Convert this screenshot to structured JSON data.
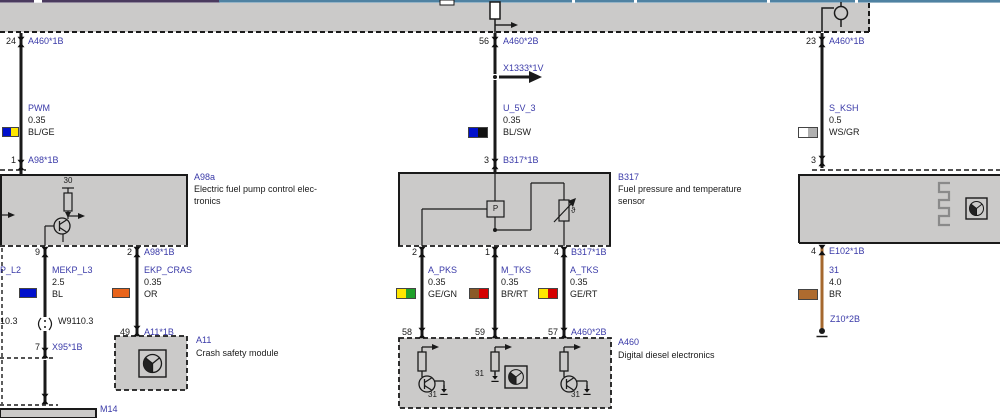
{
  "colors": {
    "accent_blue": "#3A3AA8",
    "band_gray": "#CBCAC9",
    "bus_purple": "#4A3A5E",
    "bus_blue": "#4F82A2",
    "wire_black": "#1a1a1a",
    "wire_brown": "#A5682E",
    "swatch": {
      "BL": "#0010CC",
      "GE": "#FFE600",
      "SW": "#111111",
      "WS": "#FFFFFF",
      "GR": "#B0B0B0",
      "GN": "#1FA02A",
      "OR": "#E8641B",
      "BR": "#8A5A28",
      "RT": "#D40000"
    }
  },
  "cols": {
    "pwm": {
      "pin_top": "24",
      "conn_top": "A460*1B",
      "name": "PWM",
      "size": "0.35",
      "code": "BL/GE",
      "pin_bot": "1",
      "conn_bot": "A98*1B"
    },
    "u5v": {
      "pin_top": "56",
      "conn_top": "A460*2B",
      "splice": "X1333*1V",
      "name": "U_5V_3",
      "size": "0.35",
      "code": "BL/SW",
      "pin_bot": "3",
      "conn_bot": "B317*1B"
    },
    "sksh": {
      "pin_top": "23",
      "conn_top": "A460*1B",
      "name": "S_KSH",
      "size": "0.5",
      "code": "WS/GR",
      "pin_bot": "3"
    },
    "mekp": {
      "pin_top": "9",
      "name": "MEKP_L3",
      "size": "2.5",
      "code": "BL",
      "splice": "W9110.3",
      "pin_mid": "7",
      "conn_mid": "X95*1B"
    },
    "ekp": {
      "pin_top": "2",
      "conn_top": "A98*1B",
      "name": "EKP_CRAS",
      "size": "0.35",
      "code": "OR",
      "pin_bot": "49",
      "conn_bot": "A11*1B"
    },
    "apks": {
      "pin_top": "2",
      "name": "A_PKS",
      "size": "0.35",
      "code": "GE/GN",
      "pin_bot": "58"
    },
    "mtks": {
      "pin_top": "1",
      "name": "M_TKS",
      "size": "0.35",
      "code": "BR/RT",
      "pin_bot": "59"
    },
    "atks": {
      "pin_top": "4",
      "conn_top": "B317*1B",
      "name": "A_TKS",
      "size": "0.35",
      "code": "GE/RT",
      "pin_bot": "57",
      "conn_bot": "A460*2B"
    },
    "e102": {
      "pin_top": "4",
      "conn_top": "E102*1B",
      "name": "31",
      "size": "4.0",
      "code": "BR",
      "conn_bot": "Z10*2B"
    }
  },
  "fragments": {
    "left_signal": "P_L2",
    "left_splice": "10.3"
  },
  "modules": {
    "a98a": {
      "id": "A98a",
      "desc_line1": "Electric fuel pump control elec-",
      "desc_line2": "tronics",
      "terminal": "30"
    },
    "b317": {
      "id": "B317",
      "desc_line1": "Fuel pressure and temperature",
      "desc_line2": "sensor",
      "pressure": "P",
      "theta": "ϑ"
    },
    "a11": {
      "id": "A11",
      "desc": "Crash safety module"
    },
    "a460": {
      "id": "A460",
      "desc": "Digital diesel electronics",
      "gnd1": "31",
      "gnd2": "31",
      "gnd3": "31"
    },
    "m14": {
      "id": "M14"
    }
  }
}
